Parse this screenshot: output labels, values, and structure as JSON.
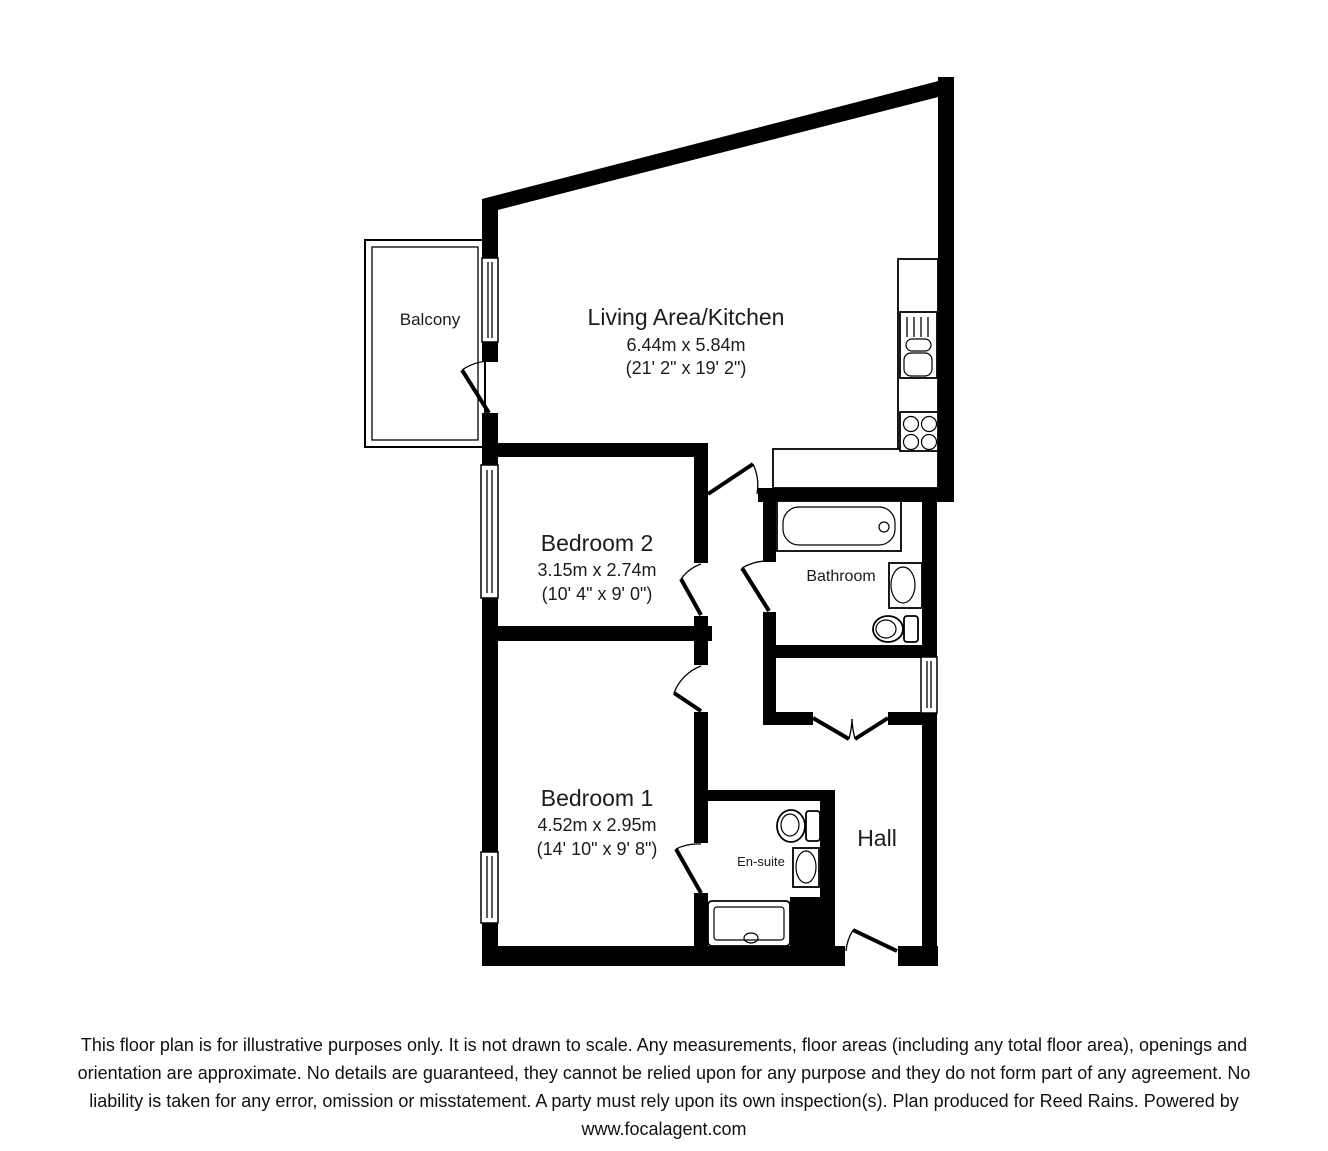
{
  "title": "Floor plan",
  "rooms": {
    "living": {
      "name": "Living Area/Kitchen",
      "dim_m": "6.44m x 5.84m",
      "dim_ft": "(21' 2\" x 19' 2\")"
    },
    "bedroom2": {
      "name": "Bedroom 2",
      "dim_m": "3.15m x 2.74m",
      "dim_ft": "(10' 4\" x 9' 0\")"
    },
    "bedroom1": {
      "name": "Bedroom 1",
      "dim_m": "4.52m x 2.95m",
      "dim_ft": "(14' 10\" x 9' 8\")"
    },
    "bathroom": {
      "name": "Bathroom"
    },
    "ensuite": {
      "name": "En-suite"
    },
    "hall": {
      "name": "Hall"
    },
    "balcony": {
      "name": "Balcony"
    }
  },
  "fixtures": [
    "kitchen-sink",
    "hob",
    "kitchen-counter",
    "bath",
    "bathroom-sink",
    "bathroom-toilet",
    "ensuite-toilet",
    "ensuite-sink",
    "shower-tray",
    "windows",
    "doors",
    "storage-double-doors"
  ],
  "footer": {
    "lines": [
      "This floor plan is for illustrative purposes only. It is not drawn to scale. Any measurements, floor areas (including any total floor area), openings and",
      "orientation are approximate. No details are guaranteed, they cannot be relied upon for any purpose and they do not form part of any agreement. No",
      "liability is taken for any error, omission or misstatement. A party must rely upon its own inspection(s). Plan produced for Reed Rains. Powered by",
      "www.focalagent.com"
    ]
  },
  "colors": {
    "wall": "#000000",
    "text": "#1c1c1c",
    "background": "#ffffff"
  }
}
